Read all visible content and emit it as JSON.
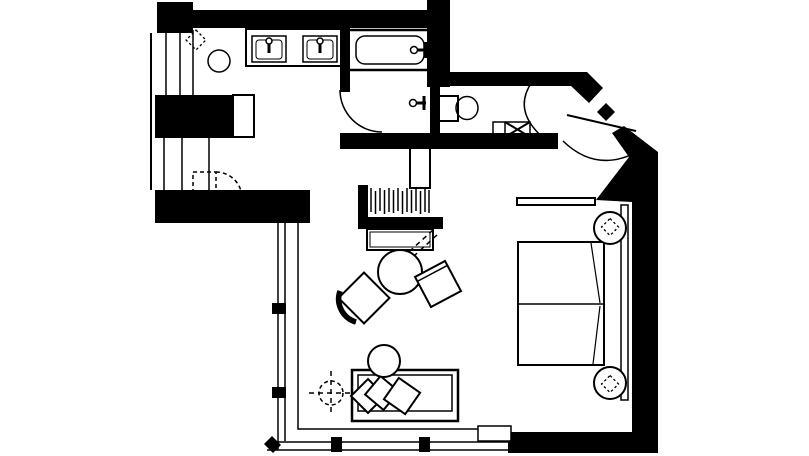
{
  "page": {
    "background": "#ffffff",
    "ink": "#000000",
    "canvas": {
      "width": 809,
      "height": 456
    }
  },
  "floor_plan": {
    "description": "hotel-room-floor-plan",
    "elements": [
      {
        "name": "wall-top-left-block",
        "type": "rect",
        "attrs": {
          "x": 157,
          "y": 2,
          "width": 36,
          "height": 31,
          "fill": "#000000",
          "stroke": "none"
        }
      },
      {
        "name": "wall-top",
        "type": "rect",
        "attrs": {
          "x": 157,
          "y": 10,
          "width": 290,
          "height": 18,
          "fill": "#000000",
          "stroke": "none"
        }
      },
      {
        "name": "wall-bath-right-block",
        "type": "rect",
        "attrs": {
          "x": 427,
          "y": 0,
          "width": 23,
          "height": 87,
          "fill": "#000000",
          "stroke": "none"
        }
      },
      {
        "name": "wall-wc-top",
        "type": "rect",
        "attrs": {
          "x": 438,
          "y": 72,
          "width": 134,
          "height": 14,
          "fill": "#000000",
          "stroke": "none"
        }
      },
      {
        "name": "wall-entry-diagonal-upper",
        "type": "polygon",
        "attrs": {
          "points": "570,72 587,72 603,88 589,103 570,85",
          "fill": "#000000",
          "stroke": "none"
        }
      },
      {
        "name": "entry-door-jamb-nub",
        "type": "polygon",
        "attrs": {
          "points": "597,112 606,103 615,112 606,121",
          "fill": "#000000",
          "stroke": "none"
        }
      },
      {
        "name": "wall-right",
        "type": "path",
        "attrs": {
          "d": "M624,126 L658,152 L658,453 L508,453 L508,432 L632,432 L632,202 L596,200 L629,157 L612,133 Z",
          "fill": "#000000",
          "stroke": "none"
        }
      },
      {
        "name": "wall-mid-horizontal",
        "type": "rect",
        "attrs": {
          "x": 340,
          "y": 133,
          "width": 218,
          "height": 16,
          "fill": "#000000",
          "stroke": "none"
        }
      },
      {
        "name": "wall-tub-left",
        "type": "rect",
        "attrs": {
          "x": 340,
          "y": 28,
          "width": 10,
          "height": 64,
          "fill": "#000000",
          "stroke": "none"
        }
      },
      {
        "name": "wall-wc-left",
        "type": "rect",
        "attrs": {
          "x": 430,
          "y": 86,
          "width": 10,
          "height": 49,
          "fill": "#000000",
          "stroke": "none"
        }
      },
      {
        "name": "wall-left-block",
        "type": "rect",
        "attrs": {
          "x": 155,
          "y": 95,
          "width": 78,
          "height": 43,
          "fill": "#000000",
          "stroke": "none"
        }
      },
      {
        "name": "wall-bottom-left",
        "type": "rect",
        "attrs": {
          "x": 155,
          "y": 190,
          "width": 155,
          "height": 33,
          "fill": "#000000",
          "stroke": "none"
        }
      },
      {
        "name": "closet-wall-left",
        "type": "rect",
        "attrs": {
          "x": 358,
          "y": 185,
          "width": 10,
          "height": 44,
          "fill": "#000000",
          "stroke": "none"
        }
      },
      {
        "name": "closet-wall-bottom",
        "type": "rect",
        "attrs": {
          "x": 358,
          "y": 217,
          "width": 85,
          "height": 12,
          "fill": "#000000",
          "stroke": "none"
        }
      },
      {
        "name": "wall-left-line",
        "type": "line",
        "attrs": {
          "x1": 151,
          "y1": 33,
          "x2": 151,
          "y2": 190,
          "stroke-width": 2
        }
      },
      {
        "name": "left-shaft-lines",
        "type": "path",
        "attrs": {
          "d": "M166,33 L166,96 M180,33 L180,96 M193,30 L193,95 M164,135 L164,190 M182,135 L182,190 M209,134 L209,192 M187,134 L209,134",
          "stroke-width": 1.5
        }
      },
      {
        "name": "cabinet-column",
        "type": "rect",
        "attrs": {
          "x": 233,
          "y": 95,
          "width": 21,
          "height": 42,
          "fill": "#ffffff",
          "stroke-width": 2
        }
      },
      {
        "name": "window-left-glass",
        "type": "path",
        "attrs": {
          "d": "M278,223 L278,450 M285,223 L285,441",
          "stroke-width": 1.5
        }
      },
      {
        "name": "window-bottom-glass",
        "type": "path",
        "attrs": {
          "d": "M269,442 L508,442 M267,450 L508,450",
          "stroke-width": 1.5
        }
      },
      {
        "name": "window-inner-floor-line",
        "type": "path",
        "attrs": {
          "d": "M298,223 L298,429 L478,429",
          "stroke-width": 1.5
        }
      },
      {
        "name": "mullion-left-1",
        "type": "rect",
        "attrs": {
          "x": 272,
          "y": 303,
          "width": 14,
          "height": 11,
          "fill": "#000000",
          "stroke": "none"
        }
      },
      {
        "name": "mullion-left-2",
        "type": "rect",
        "attrs": {
          "x": 272,
          "y": 387,
          "width": 14,
          "height": 11,
          "fill": "#000000",
          "stroke": "none"
        }
      },
      {
        "name": "mullion-bottom-1",
        "type": "rect",
        "attrs": {
          "x": 331,
          "y": 437,
          "width": 11,
          "height": 15,
          "fill": "#000000",
          "stroke": "none"
        }
      },
      {
        "name": "mullion-bottom-2",
        "type": "rect",
        "attrs": {
          "x": 419,
          "y": 437,
          "width": 11,
          "height": 15,
          "fill": "#000000",
          "stroke": "none"
        }
      },
      {
        "name": "mullion-corner",
        "type": "polygon",
        "attrs": {
          "points": "264,444 272,436 281,445 273,453",
          "fill": "#000000",
          "stroke": "none"
        }
      },
      {
        "name": "window-ledge",
        "type": "rect",
        "attrs": {
          "x": 478,
          "y": 426,
          "width": 33,
          "height": 15,
          "fill": "#ffffff",
          "stroke-width": 1.5
        }
      },
      {
        "name": "vanity-counter",
        "type": "rect",
        "attrs": {
          "x": 246,
          "y": 29,
          "width": 95,
          "height": 37,
          "stroke-width": 2
        }
      },
      {
        "name": "sink-left",
        "type": "rect",
        "attrs": {
          "x": 252,
          "y": 36,
          "width": 34,
          "height": 26,
          "stroke-width": 1.5
        }
      },
      {
        "name": "sink-left-basin",
        "type": "rect",
        "attrs": {
          "x": 256,
          "y": 40,
          "width": 26,
          "height": 19,
          "rx": 3,
          "stroke-width": 1
        }
      },
      {
        "name": "sink-left-faucet-stem",
        "type": "path",
        "attrs": {
          "d": "M269,44 L269,53",
          "stroke-width": 3
        }
      },
      {
        "name": "sink-left-faucet",
        "type": "circle",
        "attrs": {
          "cx": 269,
          "cy": 41,
          "r": 3,
          "fill": "#ffffff",
          "stroke-width": 1.5
        }
      },
      {
        "name": "sink-right",
        "type": "rect",
        "attrs": {
          "x": 303,
          "y": 36,
          "width": 34,
          "height": 26,
          "stroke-width": 1.5
        }
      },
      {
        "name": "sink-right-basin",
        "type": "rect",
        "attrs": {
          "x": 307,
          "y": 40,
          "width": 26,
          "height": 19,
          "rx": 3,
          "stroke-width": 1
        }
      },
      {
        "name": "sink-right-faucet-stem",
        "type": "path",
        "attrs": {
          "d": "M320,44 L320,53",
          "stroke-width": 3
        }
      },
      {
        "name": "sink-right-faucet",
        "type": "circle",
        "attrs": {
          "cx": 320,
          "cy": 41,
          "r": 3,
          "fill": "#ffffff",
          "stroke-width": 1.5
        }
      },
      {
        "name": "vanity-stool",
        "type": "circle",
        "attrs": {
          "cx": 219,
          "cy": 61,
          "r": 11,
          "stroke-width": 1.5
        }
      },
      {
        "name": "plant-vanity",
        "type": "rect",
        "attrs": {
          "x": -7,
          "y": -7,
          "width": 14,
          "height": 14,
          "transform": "translate(196,40) rotate(45)",
          "stroke-dasharray": "2.5 2.5",
          "stroke-width": 1.3
        }
      },
      {
        "name": "bathtub",
        "type": "rect",
        "attrs": {
          "x": 347,
          "y": 30,
          "width": 84,
          "height": 40,
          "stroke-width": 2.5
        }
      },
      {
        "name": "bathtub-basin",
        "type": "rect",
        "attrs": {
          "x": 356,
          "y": 36,
          "width": 68,
          "height": 28,
          "rx": 9,
          "stroke-width": 1.5
        }
      },
      {
        "name": "tub-faucet-bars",
        "type": "path",
        "attrs": {
          "d": "M413,50 L428,50 M426,42 L426,58",
          "stroke-width": 3
        }
      },
      {
        "name": "tub-faucet-knob",
        "type": "circle",
        "attrs": {
          "cx": 414,
          "cy": 50,
          "r": 3.5,
          "fill": "#ffffff",
          "stroke-width": 1.5
        }
      },
      {
        "name": "shower-door-arc",
        "type": "path",
        "attrs": {
          "d": "M340,90 A42,42 0 0 0 382,132",
          "stroke-width": 1.5
        }
      },
      {
        "name": "shower-valve-bars",
        "type": "path",
        "attrs": {
          "d": "M412,103 L426,103 M424,96 L424,110",
          "stroke-width": 3
        }
      },
      {
        "name": "shower-valve-knob",
        "type": "circle",
        "attrs": {
          "cx": 413,
          "cy": 103,
          "r": 3.5,
          "fill": "#ffffff",
          "stroke-width": 1.5
        }
      },
      {
        "name": "toilet-tank",
        "type": "rect",
        "attrs": {
          "x": 438,
          "y": 96,
          "width": 20,
          "height": 25,
          "stroke-width": 2
        }
      },
      {
        "name": "toilet-bowl",
        "type": "ellipse",
        "attrs": {
          "cx": 467,
          "cy": 108,
          "rx": 11,
          "ry": 11.5,
          "stroke-width": 1.5
        }
      },
      {
        "name": "wc-floor-box",
        "type": "rect",
        "attrs": {
          "x": 493,
          "y": 122,
          "width": 37,
          "height": 15,
          "stroke-width": 1.5
        }
      },
      {
        "name": "wc-floor-box-divider",
        "type": "line",
        "attrs": {
          "x1": 505,
          "y1": 122,
          "x2": 505,
          "y2": 137,
          "stroke-width": 1.5
        }
      },
      {
        "name": "wc-floor-box-x",
        "type": "path",
        "attrs": {
          "d": "M505,122 L530,137 M505,137 L530,122",
          "stroke-width": 2
        }
      },
      {
        "name": "wc-door-arc",
        "type": "path",
        "attrs": {
          "d": "M532,82 Q511,112 547,141",
          "stroke-width": 1.5
        }
      },
      {
        "name": "entry-door-leaf",
        "type": "line",
        "attrs": {
          "x1": 567,
          "y1": 115,
          "x2": 636,
          "y2": 131,
          "stroke-width": 2
        }
      },
      {
        "name": "entry-door-arc",
        "type": "path",
        "attrs": {
          "d": "M563,141 Q597,174 639,151",
          "stroke-width": 1.5
        }
      },
      {
        "name": "closet-hangers",
        "type": "path",
        "attrs": {
          "d": "M371,188 L371,212 M375.5,191 L375.5,214 M380,188 L380,211 M384.5,190 L384.5,214 M389,188 L389,212 M393.5,190 L393.5,213 M398,188 L398,211 M402.5,191 L402.5,214 M407,188 L407,212 M411.5,190 L411.5,213 M416,188 L416,211 M420.5,191 L420.5,214 M425,188 L425,212 M429,190 L429,213",
          "stroke-width": 1.5
        }
      },
      {
        "name": "cabinet-tall",
        "type": "rect",
        "attrs": {
          "x": 410,
          "y": 148,
          "width": 20,
          "height": 40,
          "fill": "#ffffff",
          "stroke-width": 2
        }
      },
      {
        "name": "console-table",
        "type": "rect",
        "attrs": {
          "x": 367,
          "y": 229,
          "width": 66,
          "height": 21,
          "fill": "#ffffff",
          "stroke-width": 2
        }
      },
      {
        "name": "console-table-inner",
        "type": "rect",
        "attrs": {
          "x": 370,
          "y": 232,
          "width": 60,
          "height": 15,
          "stroke-width": 1
        }
      },
      {
        "name": "tv-swivel-dashes",
        "type": "path",
        "attrs": {
          "d": "M433,230 L389,270 M437,235 L393,275 M389,270 L397,277",
          "stroke-dasharray": "5 4",
          "stroke-width": 1.5
        }
      },
      {
        "name": "luggage-door-dashed",
        "type": "rect",
        "attrs": {
          "x": 193,
          "y": 172,
          "width": 23,
          "height": 26,
          "stroke-dasharray": "4 3",
          "stroke-width": 1.5
        }
      },
      {
        "name": "luggage-door-arc",
        "type": "path",
        "attrs": {
          "d": "M216,172 A26,26 0 0 1 242,198",
          "stroke-dasharray": "4 3",
          "stroke-width": 1.5
        }
      },
      {
        "name": "coffee-table",
        "type": "circle",
        "attrs": {
          "cx": 400,
          "cy": 272,
          "r": 22,
          "fill": "#ffffff",
          "stroke-width": 2
        }
      },
      {
        "name": "chair-left-seat",
        "type": "rect",
        "attrs": {
          "x": -18,
          "y": -18,
          "width": 36,
          "height": 36,
          "transform": "translate(364,298) rotate(45)",
          "fill": "#ffffff",
          "stroke-width": 2
        }
      },
      {
        "name": "chair-left-back",
        "type": "path",
        "attrs": {
          "d": "M340,291 A24,24 0 0 0 356,322",
          "stroke-width": 5.5
        }
      },
      {
        "name": "chair-right-seat",
        "type": "rect",
        "attrs": {
          "x": -17,
          "y": -17,
          "width": 34,
          "height": 34,
          "transform": "translate(438,284) rotate(-28)",
          "fill": "#ffffff",
          "stroke-width": 2
        }
      },
      {
        "name": "chair-right-back",
        "type": "line",
        "attrs": {
          "x1": -17,
          "y1": -12,
          "x2": 17,
          "y2": -12,
          "transform": "translate(438,284) rotate(-28)",
          "stroke-width": 1.5
        }
      },
      {
        "name": "sofa",
        "type": "rect",
        "attrs": {
          "x": 352,
          "y": 370,
          "width": 106,
          "height": 51,
          "fill": "#ffffff",
          "stroke-width": 2.5
        }
      },
      {
        "name": "sofa-inner",
        "type": "rect",
        "attrs": {
          "x": 358,
          "y": 375,
          "width": 94,
          "height": 36,
          "stroke-width": 1.5
        }
      },
      {
        "name": "sofa-pillow-1",
        "type": "rect",
        "attrs": {
          "x": -12,
          "y": -12,
          "width": 24,
          "height": 24,
          "transform": "translate(368,396) rotate(45)",
          "fill": "#ffffff",
          "stroke-width": 2
        }
      },
      {
        "name": "sofa-pillow-2",
        "type": "rect",
        "attrs": {
          "x": -12,
          "y": -12,
          "width": 24,
          "height": 24,
          "transform": "translate(382,393) rotate(40)",
          "fill": "#ffffff",
          "stroke-width": 2
        }
      },
      {
        "name": "sofa-pillow-3",
        "type": "rect",
        "attrs": {
          "x": -13,
          "y": -13,
          "width": 26,
          "height": 26,
          "transform": "translate(402,396) rotate(35)",
          "fill": "#ffffff",
          "stroke-width": 2
        }
      },
      {
        "name": "ottoman",
        "type": "circle",
        "attrs": {
          "cx": 384,
          "cy": 361,
          "r": 16,
          "fill": "#ffffff",
          "stroke-width": 2
        }
      },
      {
        "name": "ceiling-light-circle",
        "type": "circle",
        "attrs": {
          "cx": 331,
          "cy": 393,
          "r": 12,
          "stroke-dasharray": "4 3",
          "stroke-width": 1.5
        }
      },
      {
        "name": "ceiling-light-cross",
        "type": "path",
        "attrs": {
          "d": "M309,393 L353,393 M331,371 L331,415",
          "stroke-dasharray": "5 4",
          "stroke-width": 1.5
        }
      },
      {
        "name": "bed-shelf",
        "type": "rect",
        "attrs": {
          "x": 517,
          "y": 198,
          "width": 78,
          "height": 7,
          "fill": "#ffffff",
          "stroke-width": 2
        }
      },
      {
        "name": "bed",
        "type": "rect",
        "attrs": {
          "x": 518,
          "y": 242,
          "width": 86,
          "height": 123,
          "fill": "#ffffff",
          "stroke-width": 2
        }
      },
      {
        "name": "bed-divider",
        "type": "line",
        "attrs": {
          "x1": 518,
          "y1": 304,
          "x2": 604,
          "y2": 304,
          "stroke-width": 1.5
        }
      },
      {
        "name": "bed-duvet-folds",
        "type": "path",
        "attrs": {
          "d": "M591,243 L600,303 M600,306 L593,364",
          "stroke-width": 1.2
        }
      },
      {
        "name": "headboard",
        "type": "rect",
        "attrs": {
          "x": 621,
          "y": 205,
          "width": 7,
          "height": 195,
          "fill": "#ffffff",
          "stroke-width": 1.5
        }
      },
      {
        "name": "nightstand-top",
        "type": "circle",
        "attrs": {
          "cx": 610,
          "cy": 228,
          "r": 16,
          "fill": "#ffffff",
          "stroke-width": 2
        }
      },
      {
        "name": "nightstand-bottom",
        "type": "circle",
        "attrs": {
          "cx": 610,
          "cy": 383,
          "r": 16,
          "fill": "#ffffff",
          "stroke-width": 2
        }
      },
      {
        "name": "plant-nightstand-top",
        "type": "rect",
        "attrs": {
          "x": -6,
          "y": -6,
          "width": 12,
          "height": 12,
          "transform": "translate(610,227) rotate(45)",
          "stroke-dasharray": "2.5 2.5",
          "stroke-width": 1.3
        }
      },
      {
        "name": "plant-nightstand-bottom",
        "type": "rect",
        "attrs": {
          "x": -6,
          "y": -6,
          "width": 12,
          "height": 12,
          "transform": "translate(610,384) rotate(45)",
          "stroke-dasharray": "2.5 2.5",
          "stroke-width": 1.3
        }
      }
    ]
  }
}
